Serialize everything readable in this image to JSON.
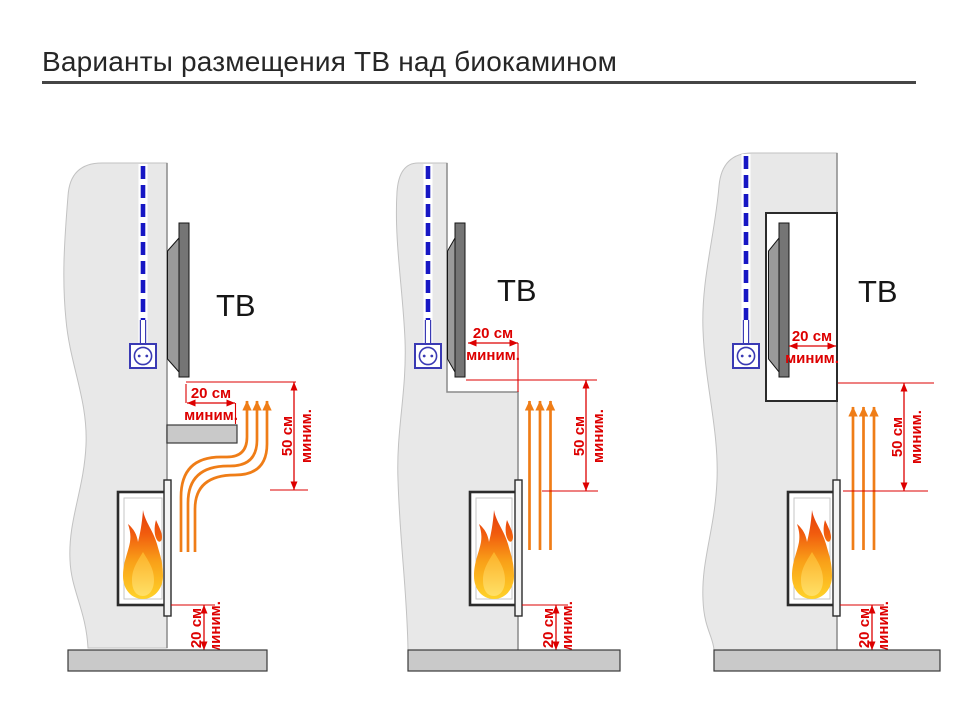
{
  "title": "Варианты размещения ТВ над биокамином",
  "colors": {
    "dimension_red": "#dd0000",
    "heat_arrow_orange": "#ef7d17",
    "cable_blue": "#1717c4",
    "outlet_blue": "#3a3ab4",
    "wall_gray": "#e8e8e8",
    "slab_gray": "#c9c9c9",
    "tv_gray": "#757575",
    "flame_yellow": "#ffd42a",
    "flame_red": "#e23a0b"
  },
  "diagrams": [
    {
      "tv_label": "ТВ",
      "dim_front": {
        "value": "20 см",
        "qualifier": "миним."
      },
      "dim_vertical": {
        "value": "50 см",
        "qualifier": "миним."
      },
      "dim_floor": {
        "value": "20 см",
        "qualifier": "миним."
      }
    },
    {
      "tv_label": "ТВ",
      "dim_front": {
        "value": "20 см",
        "qualifier": "миним."
      },
      "dim_vertical": {
        "value": "50 см",
        "qualifier": "миним."
      },
      "dim_floor": {
        "value": "20 см",
        "qualifier": "миним."
      }
    },
    {
      "tv_label": "ТВ",
      "dim_front": {
        "value": "20 см",
        "qualifier": "миним."
      },
      "dim_vertical": {
        "value": "50 см",
        "qualifier": "миним."
      },
      "dim_floor": {
        "value": "20 см",
        "qualifier": "миним."
      }
    }
  ]
}
